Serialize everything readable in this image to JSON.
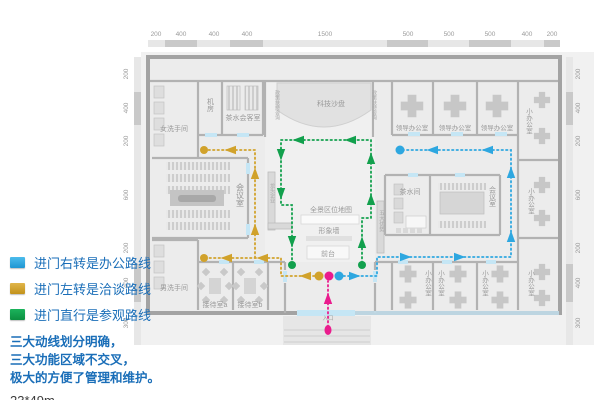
{
  "colors": {
    "route_office_blue": "#2ea7e0",
    "route_talk_gold": "#d1a22b",
    "route_visit_green": "#12a04d",
    "route_enter_pink": "#ea1c8d",
    "legend_text_blue": "#1a6eb8",
    "wall_gray": "#b2b2b2",
    "door_lightblue": "#c5e6f5"
  },
  "legend": {
    "items": [
      {
        "id": "office",
        "label": "进门右转是办公路线",
        "color": "#29abe2"
      },
      {
        "id": "talk",
        "label": "进门左转是洽谈路线",
        "color": "#c2921b"
      },
      {
        "id": "visit",
        "label": "进门直行是参观路线",
        "color": "#0c8f40"
      }
    ],
    "notes": [
      "三大动线划分明确，",
      "三大功能区域不交叉，",
      "极大的方便了管理和维护。"
    ],
    "size_label": "23*49m"
  },
  "plan": {
    "dims_top": [
      "200",
      "400",
      "400",
      "400",
      "1500",
      "500",
      "500",
      "500",
      "400",
      "200"
    ],
    "dims_side": [
      "200",
      "400",
      "200",
      "600",
      "200",
      "400",
      "300"
    ],
    "rooms": {
      "women_wc": "女洗手间",
      "machine_room": "机房",
      "tea_reception": "茶水会客室",
      "tech_sandbox": "科技沙盘",
      "policy_support": "政策扶持咨询",
      "leader_office": "领导办公室",
      "small_office": "小办公室",
      "meeting_room": "会议室",
      "tea_room": "茶水间",
      "leading_enterprise": "龙头企业",
      "five_advantages": "五大优势",
      "panorama_map": "全景区位地图",
      "image_wall": "形象墙",
      "front_desk": "前台",
      "men_wc": "男洗手间",
      "reception_a": "接待室a",
      "reception_b": "接待室b",
      "entrance": "入口"
    }
  }
}
